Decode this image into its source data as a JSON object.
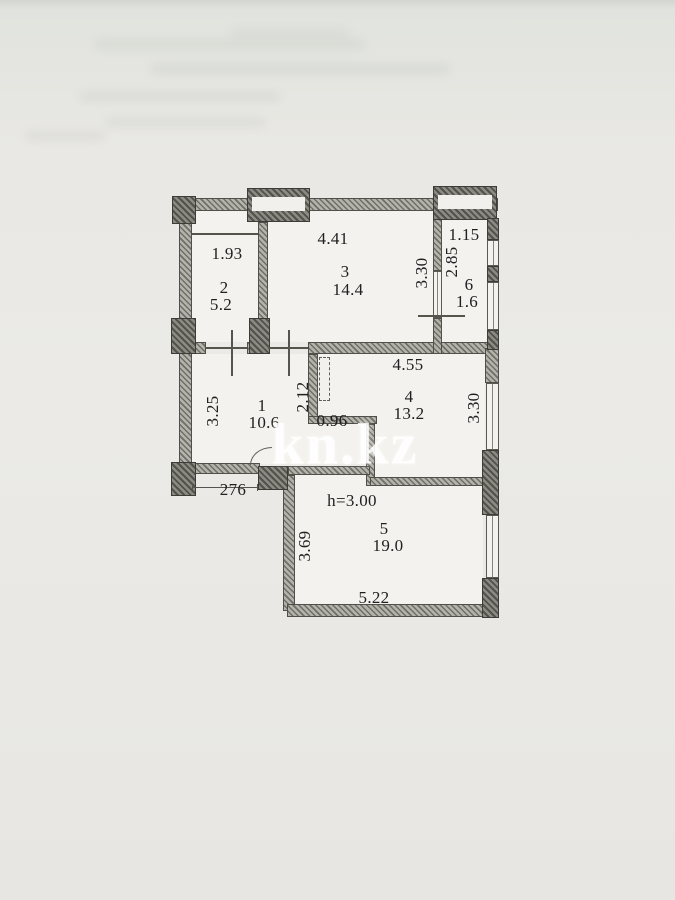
{
  "document": {
    "kind": "apartment floor plan scan",
    "colors": {
      "paper": "#e9e8e4",
      "room_fill": "#f3f2ee",
      "ink": "#202022",
      "wall_gray": "#8b8b83",
      "watermark": "#ffffff"
    }
  },
  "watermark": {
    "text": "kn.kz"
  },
  "rooms": {
    "r1": {
      "number": "1",
      "area": "10.6"
    },
    "r2": {
      "number": "2",
      "area": "5.2"
    },
    "r3": {
      "number": "3",
      "area": "14.4"
    },
    "r4": {
      "number": "4",
      "area": "13.2"
    },
    "r5": {
      "number": "5",
      "area": "19.0"
    },
    "r6": {
      "number": "6",
      "area": "1.6"
    }
  },
  "dims": {
    "r2_w": "1.93",
    "r3_w": "4.41",
    "r3_h": "3.30",
    "r6_w": "1.15",
    "r6_h": "2.85",
    "r4_w": "4.55",
    "r4_h": "3.30",
    "hall_h": "3.25",
    "niche_h": "2.12",
    "passage_w": "0.96",
    "hall_bottom": "276",
    "ceiling_h": "h=3.00",
    "r5_h": "3.69",
    "r5_w": "5.22"
  }
}
